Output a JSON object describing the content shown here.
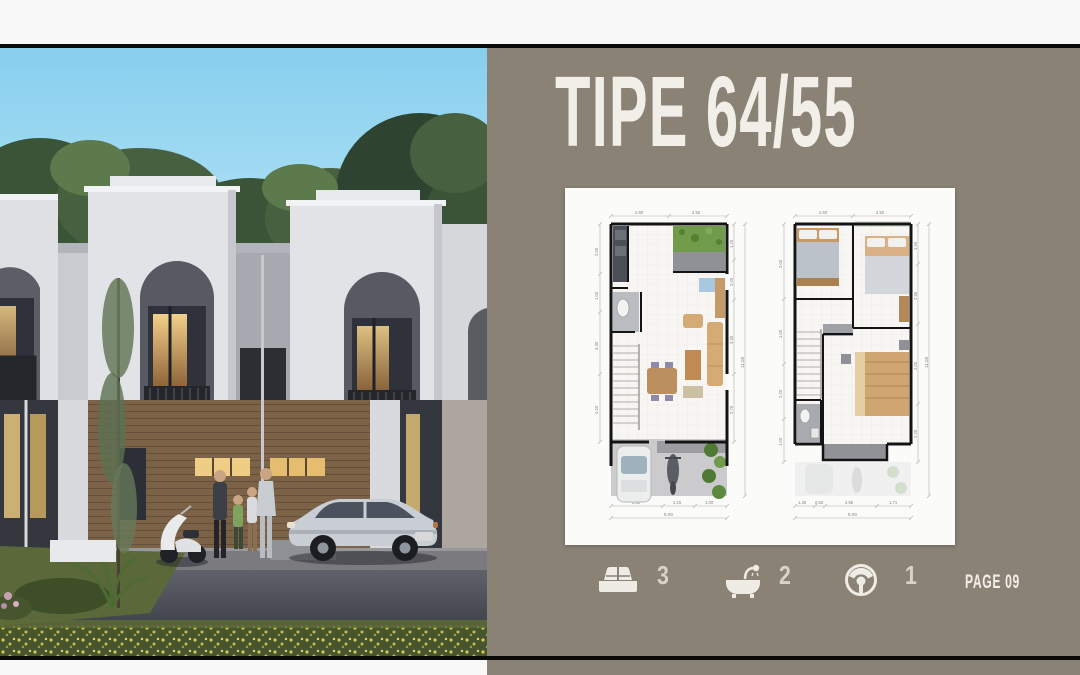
{
  "page": {
    "title": "TIPE 64/55",
    "page_label": "PAGE 09"
  },
  "stats": {
    "bedrooms": "3",
    "bathrooms": "2",
    "carport": "1"
  },
  "icons": {
    "bedrooms": "bed-icon",
    "bathrooms": "bathtub-icon",
    "carport": "steering-wheel-icon"
  },
  "colors": {
    "canvas_bg": "#f8f8f8",
    "frame_line": "#0c0a08",
    "panel_bg": "#8a8275",
    "panel_text": "#f2efe9",
    "stat_text": "#d8d3c9",
    "card_bg": "#fbfbfa",
    "sky_top": "#87cfee",
    "sky_bottom": "#c9ecf8",
    "facade": "#e2e3e7",
    "window_glow": "#e9bd6d",
    "road": "#3a3c44",
    "grass": "#55652f"
  },
  "floor_plans": {
    "ground": {
      "top_dims": [
        "2.80",
        "2.55"
      ],
      "left_dims": [
        "2.00",
        "1.00",
        "3.30",
        "4.00"
      ],
      "right_dims": [
        "1.20",
        "2.00",
        "3.30",
        "2.75"
      ],
      "right_total": "11.00",
      "bottom_dims": [
        "2.80",
        "1.15",
        "1.00"
      ],
      "bottom_total": "5.00"
    },
    "upper": {
      "top_dims": [
        "2.50",
        "2.50"
      ],
      "left_dims": [
        "2.00",
        "1.00",
        "2.20",
        "1.00"
      ],
      "right_dims": [
        "1.50",
        "2.95",
        "4.00",
        "2.20"
      ],
      "right_total": "11.00",
      "bottom_dims": [
        "1.35",
        "0.50",
        "2.85",
        "1.71"
      ],
      "bottom_total": "5.00"
    }
  }
}
